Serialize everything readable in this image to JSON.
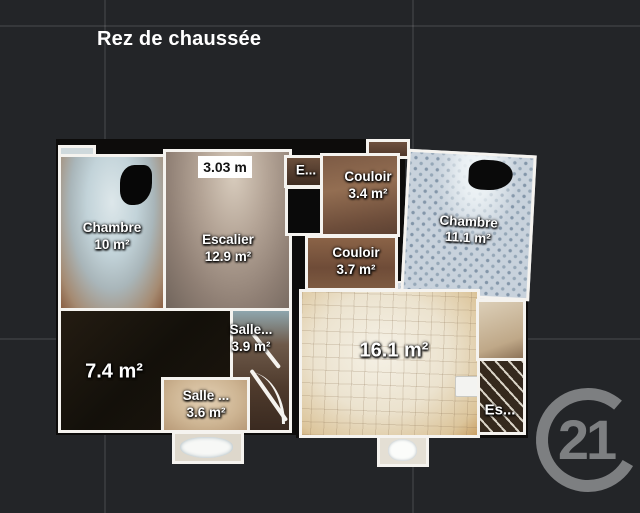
{
  "title": "Rez de chaussée",
  "measurement_label": "3.03 m",
  "rooms": {
    "chambre10": {
      "name": "Chambre",
      "area": "10 m²"
    },
    "escalier": {
      "name": "Escalier",
      "area": "12.9 m²"
    },
    "entree": {
      "name": "E..."
    },
    "couloir34": {
      "name": "Couloir",
      "area": "3.4 m²"
    },
    "couloir37": {
      "name": "Couloir",
      "area": "3.7 m²"
    },
    "chambre111": {
      "name": "Chambre",
      "area": "11.1 m²"
    },
    "room74": {
      "area": "7.4 m²"
    },
    "salle39": {
      "name": "Salle...",
      "area": "3.9 m²"
    },
    "salle36": {
      "name": "Salle ...",
      "area": "3.6 m²"
    },
    "room161": {
      "area": "16.1 m²"
    },
    "escalier_down": {
      "name": "Es..."
    }
  },
  "logo": {
    "number": "21"
  },
  "colors": {
    "background": "#232528",
    "wall": "#f5f3ef",
    "logo_gray": "#7d7f81",
    "label_text": "#ffffff"
  }
}
